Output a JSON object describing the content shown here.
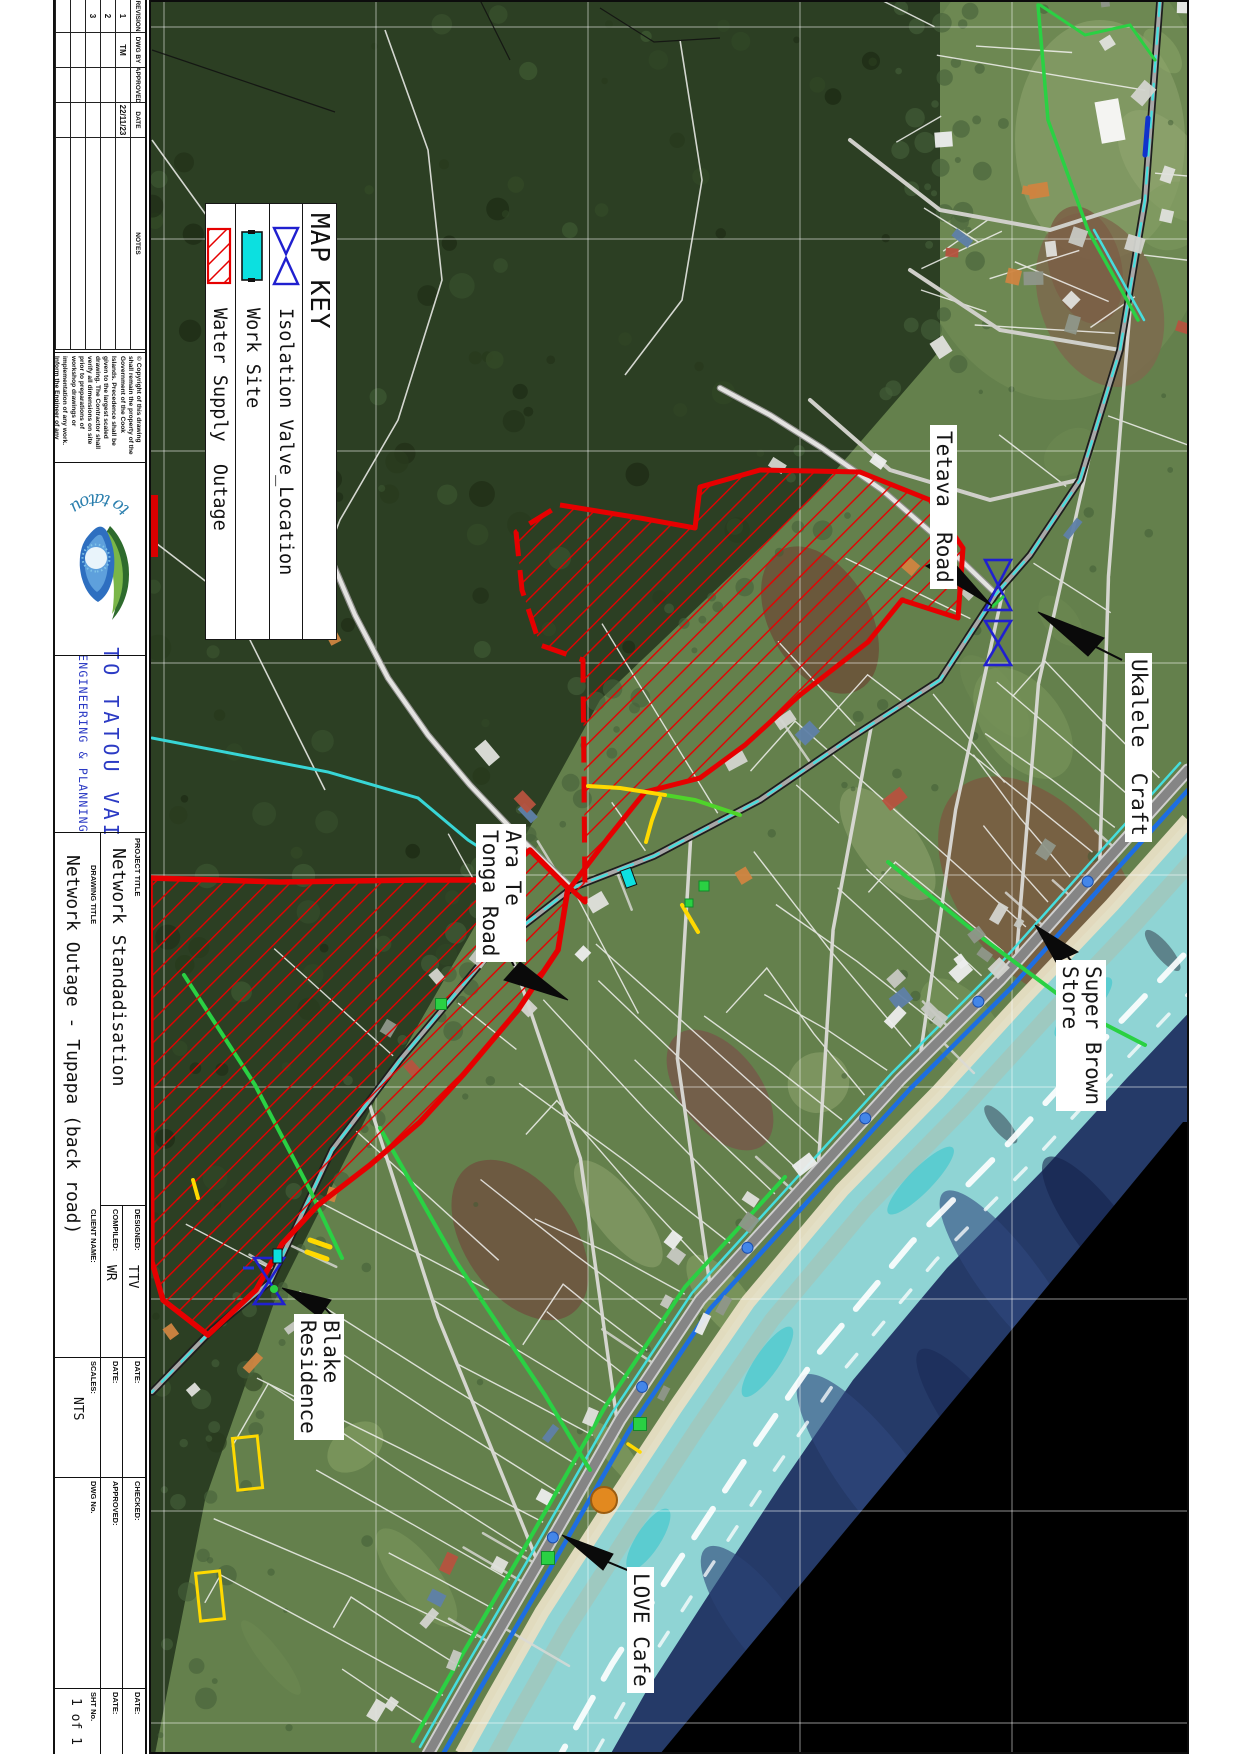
{
  "legend": {
    "title": "MAP KEY",
    "items": [
      {
        "symbol": "isolation-valve",
        "label": "Isolation Valve_Location"
      },
      {
        "symbol": "work-site",
        "label": "Work Site"
      },
      {
        "symbol": "water-supply-outage",
        "label": "Water Supply  Outage"
      }
    ]
  },
  "map_labels": {
    "tetava": {
      "lines": [
        "Tetava  Road"
      ]
    },
    "ukalele": {
      "lines": [
        "Ukalele  Craft"
      ]
    },
    "ara_te_tonga": {
      "lines": [
        "Ara Te",
        "Tonga Road"
      ]
    },
    "super_brown": {
      "lines": [
        "Super Brown",
        "Store"
      ]
    },
    "blake": {
      "lines": [
        "Blake",
        "Residence"
      ]
    },
    "love_cafe": {
      "lines": [
        "LOVE Cafe"
      ]
    }
  },
  "title_block": {
    "revision_table": {
      "headers": [
        "REVISION",
        "DWG BY",
        "APPROVED",
        "DATE",
        "NOTES"
      ],
      "rows": [
        [
          "1",
          "TM",
          "",
          "22/11/23",
          ""
        ],
        [
          "2",
          "",
          "",
          "",
          ""
        ],
        [
          "3",
          "",
          "",
          "",
          ""
        ],
        [
          "",
          "",
          "",
          "",
          ""
        ],
        [
          "",
          "",
          "",
          "",
          ""
        ]
      ]
    },
    "copyright_notice": "© Copyright of this drawing shall remain the property of the Government of the Cook Islands. Precedence shall be given to the largest scaled drawing. The Contractor shall verify all dimensions on site prior to preparations of workshop drawings or implementation of any work. Inform the Engineer of any discrepancies immediately.",
    "logo_text": "to tatou vai",
    "company_line1": "TO TATOU VAI",
    "company_line2": "ENGINEERING & PLANNING",
    "project_title_label": "PROJECT TITLE",
    "project_title": "Network Standadisation",
    "drawing_title_label": "DRAWING TITLE",
    "drawing_title": "Network Outage - Tupapa (back road)",
    "designed_label": "DESIGNED:",
    "designed": "TTV",
    "compiled_label": "COMPILED:",
    "compiled": "WR",
    "client_label": "CLIENT NAME:",
    "client": "",
    "date_label": "DATE:",
    "scales_label": "SCALES:",
    "scales": "NTS",
    "checked_label": "CHECKED:",
    "approved_label": "APPROVED:",
    "dwg_no_label": "DWG No.",
    "sht_no_label": "SHT No.",
    "sht_no": "1 of 1"
  },
  "colors": {
    "outage_red": "#e60000",
    "valve_blue": "#2020cf",
    "work_site_cyan": "#0ce0e0",
    "company_blue": "#2b3ac4",
    "pipe_green": "#2ad143",
    "water_main_blue": "#1d6ee2",
    "utility_cyan": "#45dede",
    "highlight_yellow": "#ffd900",
    "ocean_deep": "#253a68",
    "lagoon": "#8fd4d4",
    "sand": "#e8dfc4",
    "forest_green": "#2c3f23",
    "field_green": "#64804c",
    "no_imagery_black": "#000000"
  }
}
